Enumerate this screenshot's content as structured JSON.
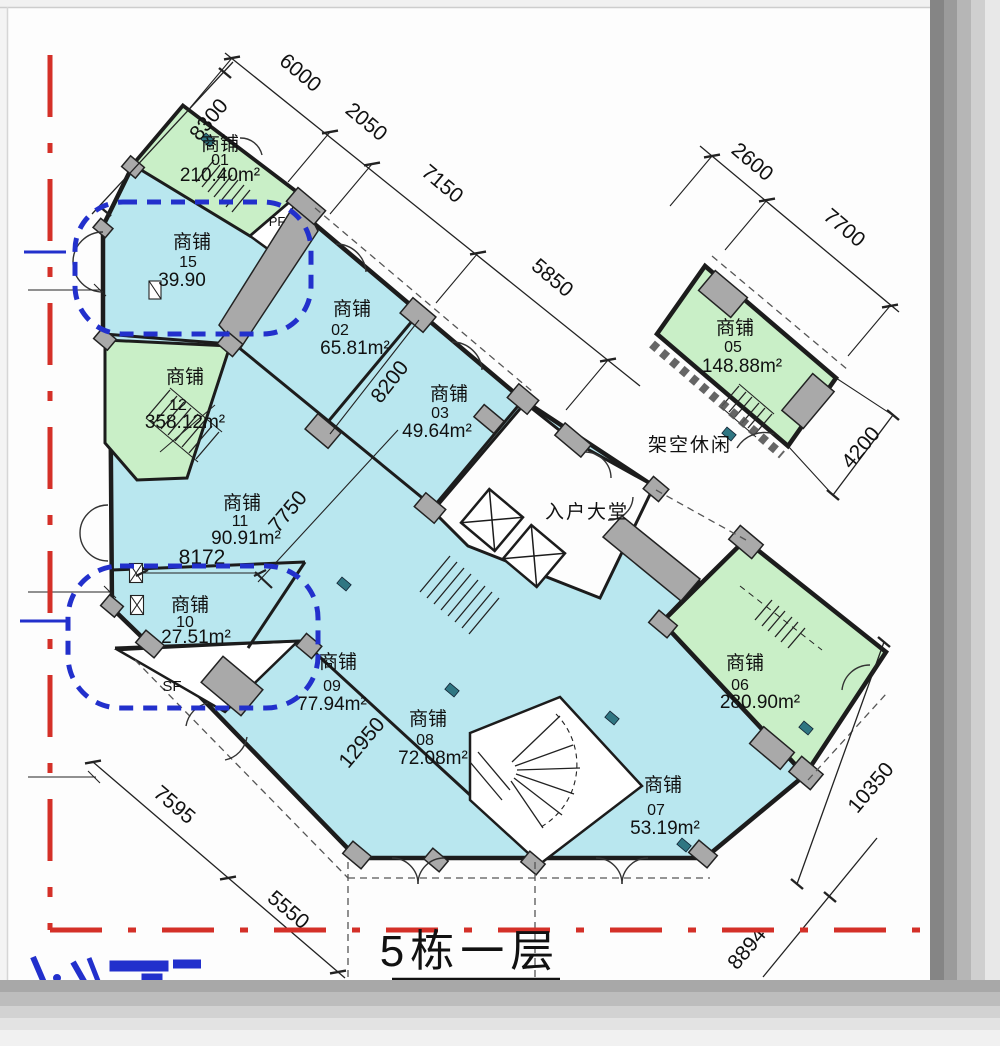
{
  "title": "5栋一层",
  "rooms": [
    {
      "key": "01",
      "label": "商铺",
      "num": "01",
      "area": "210.40m²",
      "fill": "green"
    },
    {
      "key": "15",
      "label": "商铺",
      "num": "15",
      "area": "39.90",
      "fill": "cyan"
    },
    {
      "key": "02",
      "label": "商铺",
      "num": "02",
      "area": "65.81m²",
      "fill": "cyan"
    },
    {
      "key": "03",
      "label": "商铺",
      "num": "03",
      "area": "49.64m²",
      "fill": "cyan"
    },
    {
      "key": "05",
      "label": "商铺",
      "num": "05",
      "area": "148.88m²",
      "fill": "green"
    },
    {
      "key": "12",
      "label": "商铺",
      "num": "12",
      "area": "358.12m²",
      "fill": "green"
    },
    {
      "key": "11",
      "label": "商铺",
      "num": "11",
      "area": "90.91m²",
      "fill": "cyan"
    },
    {
      "key": "10",
      "label": "商铺",
      "num": "10",
      "area": "27.51m²",
      "fill": "cyan"
    },
    {
      "key": "09",
      "label": "商铺",
      "num": "09",
      "area": "77.94m²",
      "fill": "cyan"
    },
    {
      "key": "08",
      "label": "商铺",
      "num": "08",
      "area": "72.08m²",
      "fill": "cyan"
    },
    {
      "key": "07",
      "label": "商铺",
      "num": "07",
      "area": "53.19m²",
      "fill": "cyan"
    },
    {
      "key": "06",
      "label": "商铺",
      "num": "06",
      "area": "280.90m²",
      "fill": "green"
    }
  ],
  "spaces": {
    "lobby": "入户大堂",
    "leisure": "架空休闲",
    "pf": "PF",
    "sf": "SF"
  },
  "dimensions": {
    "d8300": "8300",
    "d6000": "6000",
    "d2050": "2050",
    "d7150": "7150",
    "d5850": "5850",
    "d2600": "2600",
    "d7700": "7700",
    "d4200": "4200",
    "d8200": "8200",
    "d7750": "7750",
    "d8172": "8172",
    "d12950": "12950",
    "d10350": "10350",
    "d7595": "7595",
    "d5550": "5550",
    "d8894": "8894"
  },
  "colors": {
    "shop_cyan": "#b9e7ef",
    "shop_green": "#c9efc7",
    "wall": "#1c1c1c",
    "boundary_red": "#d43028",
    "annotation_blue": "#2230cc",
    "column_gray": "#a9a9a9"
  }
}
